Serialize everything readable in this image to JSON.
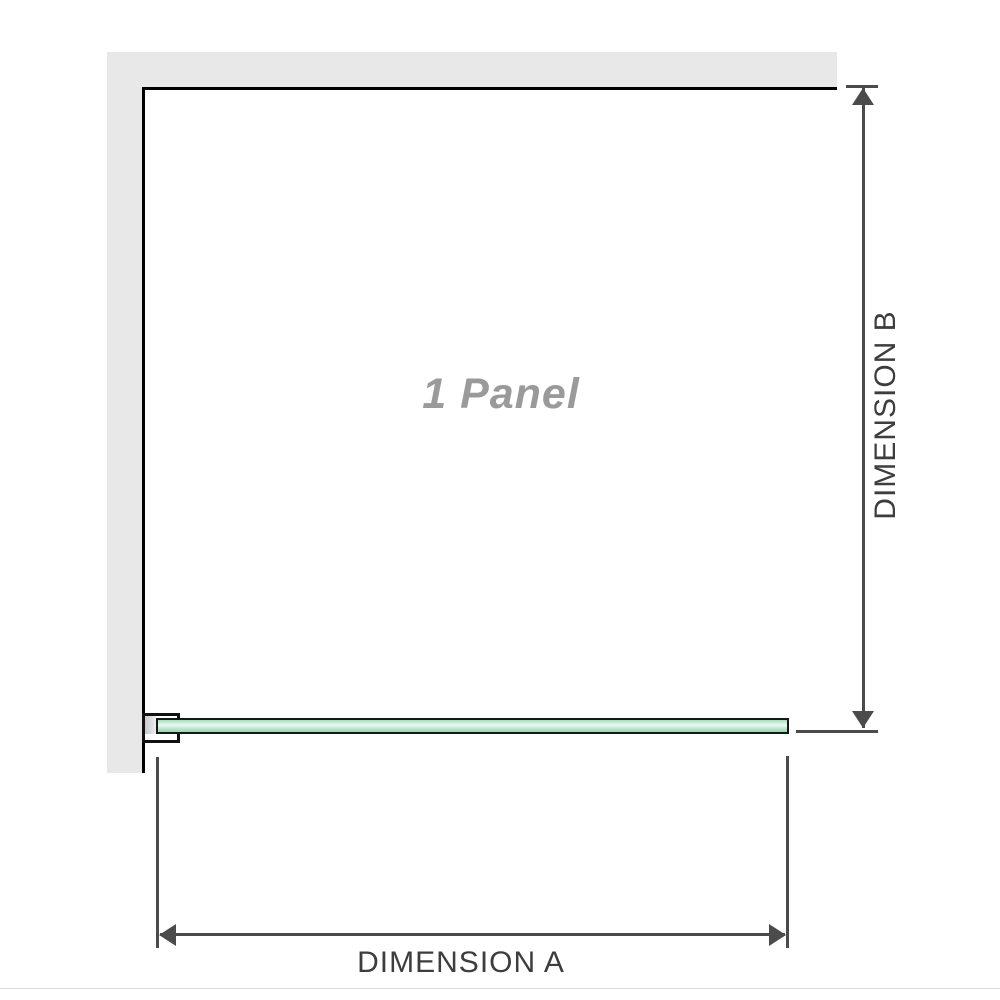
{
  "diagram": {
    "panel_label": "1 Panel",
    "dimension_a": {
      "label": "DIMENSION A"
    },
    "dimension_b": {
      "label": "DIMENSION B"
    }
  },
  "colors": {
    "background": "#ffffff",
    "wall_fill": "#e8e8e8",
    "wall_face_line": "#000000",
    "glass_fill": "#b7e3c9",
    "glass_highlight": "#ecf9f1",
    "glass_border": "#101c15",
    "bracket_border": "#111111",
    "bracket_pad_fill": "#d7d7d7",
    "dimension_line": "#4b4b4b",
    "dimension_text": "#3d3d3d",
    "panel_text": "#9a9a9a",
    "divider_line": "#dcdcdc"
  }
}
